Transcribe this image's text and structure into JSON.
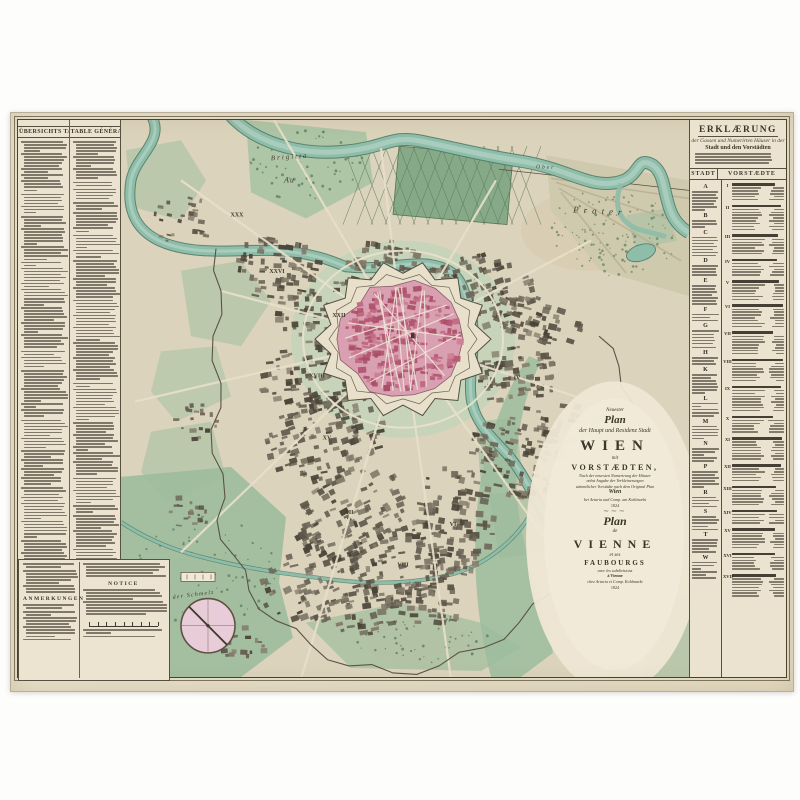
{
  "artwork": {
    "kind": "Antique engraved city map of Vienna with explanatory text panels",
    "year": "1824",
    "publisher_line": "bei Artaria und Compagnie am Kohlmarkt"
  },
  "left_panel": {
    "col1_header": "ÜBERSICHTS TABELLE",
    "col2_header": "TABLE GÉNÉRALE",
    "anmerkungen_header": "ANMERKUNGEN",
    "notice_header": "NOTICE"
  },
  "right_panel": {
    "title": "ERKLÆRUNG",
    "subtitle_script": "der Gassen und Numerirten Häuser in der",
    "subtitle_bold": "Stadt und den Vorstädten",
    "table": {
      "col1_header": "STADT",
      "col2_header": "VORSTÆDTE",
      "stadt_letters": [
        "A",
        "B",
        "C",
        "D",
        "E",
        "F",
        "G",
        "H",
        "K",
        "L",
        "M",
        "N",
        "P",
        "R",
        "S",
        "T",
        "W"
      ]
    }
  },
  "cartouche": {
    "neuester": "Neuester",
    "plan_de": "Plan",
    "der_haupt": "der Haupt und Residenz Stadt",
    "wien": "WIEN",
    "mit": "mit",
    "vorstaedten": "VORSTÆDTEN,",
    "sub1": "Nach der neuesten Numerirung der Häuser",
    "sub2": "nebst Angabe der Verkleinerungen",
    "sub3": "sämmtlicher Vorstädte nach dem Original Plan",
    "wien_script": "Wien",
    "publisher_de": "bei Artaria und Comp. am Kohlmarkt",
    "year_de": "1824",
    "plan_fr": "Plan",
    "de": "de",
    "vienne": "VIENNE",
    "et_ses": "et ses",
    "faubourgs": "FAUBOURGS",
    "sub_fr": "avec les subdivisions",
    "a_vienne": "à Vienne",
    "publisher_fr": "chez Artaria et Comp. Kohlmarkt",
    "year_fr": "1824"
  },
  "map_labels": [
    {
      "text": "Brigitta",
      "x": 150,
      "y": 40,
      "size": 7,
      "ls": 2,
      "rot": -4
    },
    {
      "text": "Au",
      "x": 163,
      "y": 62,
      "size": 8,
      "ls": 1,
      "rot": 0
    },
    {
      "text": "Ober",
      "x": 415,
      "y": 48,
      "size": 5.5,
      "ls": 2,
      "rot": 2
    },
    {
      "text": "Prater",
      "x": 452,
      "y": 92,
      "size": 9,
      "ls": 5,
      "rot": 3
    },
    {
      "text": "auf der Schmelz",
      "x": 38,
      "y": 478,
      "size": 6,
      "ls": 1.2,
      "rot": -7
    }
  ],
  "district_numerals": [
    {
      "text": "I",
      "x": 352,
      "y": 180
    },
    {
      "text": "IV",
      "x": 396,
      "y": 258
    },
    {
      "text": "VI",
      "x": 332,
      "y": 404
    },
    {
      "text": "VIII",
      "x": 282,
      "y": 444
    },
    {
      "text": "XII",
      "x": 228,
      "y": 392
    },
    {
      "text": "XV",
      "x": 206,
      "y": 318
    },
    {
      "text": "XVIII",
      "x": 196,
      "y": 256
    },
    {
      "text": "XXII",
      "x": 218,
      "y": 196
    },
    {
      "text": "XXVI",
      "x": 156,
      "y": 152
    },
    {
      "text": "XXX",
      "x": 116,
      "y": 96
    }
  ],
  "colors": {
    "paper": "#ebe3cf",
    "map_ground": "#dcd3bc",
    "inner_city_pink": "#c06a84",
    "city_area": "#d8a0b0",
    "park_green": "#9cbc9c",
    "glacis_green": "#c5d4b8",
    "river_teal": "#8ebdaa",
    "river_edge": "#4e7a66",
    "block_ink": "#55503f",
    "frame_ink": "#46402f",
    "compass_pink": "#e8ccd8"
  }
}
